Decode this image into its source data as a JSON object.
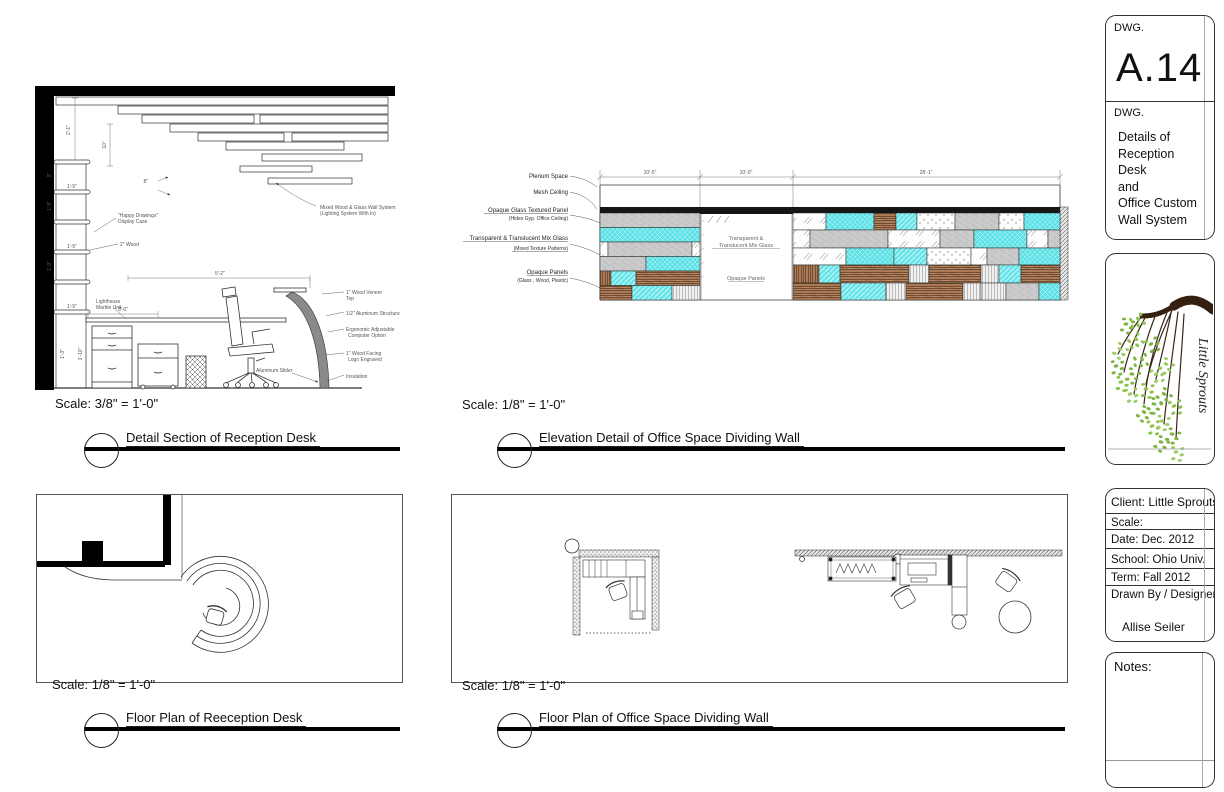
{
  "colors": {
    "accent_cyan": "#5CE1E6",
    "wood_brown": "#8A5A3B",
    "panel_gray": "#CBCBCB",
    "leaf_green": "#7CB342",
    "branch_brown": "#35200f"
  },
  "d1": {
    "scale": "Scale: 3/8\" = 1'-0\"",
    "title": "Detail Section of Reception Desk",
    "dims": {
      "wall_h": "2'-1\"",
      "ten": "10\"",
      "eight": "8\"",
      "nine": "9\"",
      "shelf1": "1'-5\"",
      "shelf2": "1'-9\"",
      "shelf3": "1'-5\"",
      "shelf4": "1'-9\"",
      "shelf5": "1'-5\"",
      "case_h": "1'-3\"",
      "case_d": "1'-10\"",
      "counter": "3'-0\"",
      "desk": "5'-2\""
    },
    "labels": {
      "wall_sys1": "Mixed Wood & Glass Wall System",
      "wall_sys2": "(Lighting System With In)",
      "case1": "\"Happy Drawings\"",
      "case2": "Display Case",
      "wood2": "2\" Wood",
      "marble1": "Lighthouse",
      "marble2": "Marble Unit",
      "veneer1": "1\" Wood Veneer",
      "veneer2": "Top",
      "alum": "1/2\" Aluminum Structure",
      "ergo1": "Ergonomic Adjustable",
      "ergo2": "Computer Option",
      "facing1": "1\" Wood Facing",
      "facing2": "Logo Engraved",
      "insul": "Insulation",
      "slider": "Aluminum Slider"
    }
  },
  "d2": {
    "scale": "Scale: 1/8\" = 1'-0\"",
    "title": "Elevation Detail of Office Space Dividing Wall",
    "dims": {
      "left": "10'-5\"",
      "mid": "10'-0\"",
      "right": "28'-1\""
    },
    "labels": {
      "plenum": "Plenum Space",
      "mesh": "Mesh Ceiling",
      "opaque_glass1": "Opaque Glass Textured Panel",
      "opaque_glass2": "(Hides Gyp. Office Ceiling)",
      "mix1": "Transparent & Translucent Mix Glass",
      "mix2": "(Mixed Texture Patterns)",
      "panels1": "Opaque Panels",
      "panels2": "(Glass , Wood, Plastic)",
      "mid1": "Transparent &",
      "mid2": "Translucent Mix Glass",
      "mid3": "Opaque Panels"
    }
  },
  "d3": {
    "scale": "Scale: 1/8\" = 1'-0\"",
    "title": "Floor Plan of Reeception Desk"
  },
  "d4": {
    "scale": "Scale: 1/8\" = 1'-0\"",
    "title": "Floor Plan of Office Space Dividing Wall"
  },
  "titleblock": {
    "dwg_label": "DWG.",
    "number": "A.14",
    "dwg_label2": "DWG.",
    "sheet_title": "Details of\nReception Desk\nand\nOffice Custom\nWall System"
  },
  "logo": {
    "name": "Little Sprouts"
  },
  "info": {
    "client": "Client: Little Sprouts",
    "scale": "Scale:",
    "date": "Date: Dec. 2012",
    "school": "School: Ohio Univ.",
    "term": "Term: Fall 2012",
    "drawn": "Drawn By / Designer:",
    "designer": "Allise Seiler"
  },
  "notes": {
    "label": "Notes:"
  }
}
